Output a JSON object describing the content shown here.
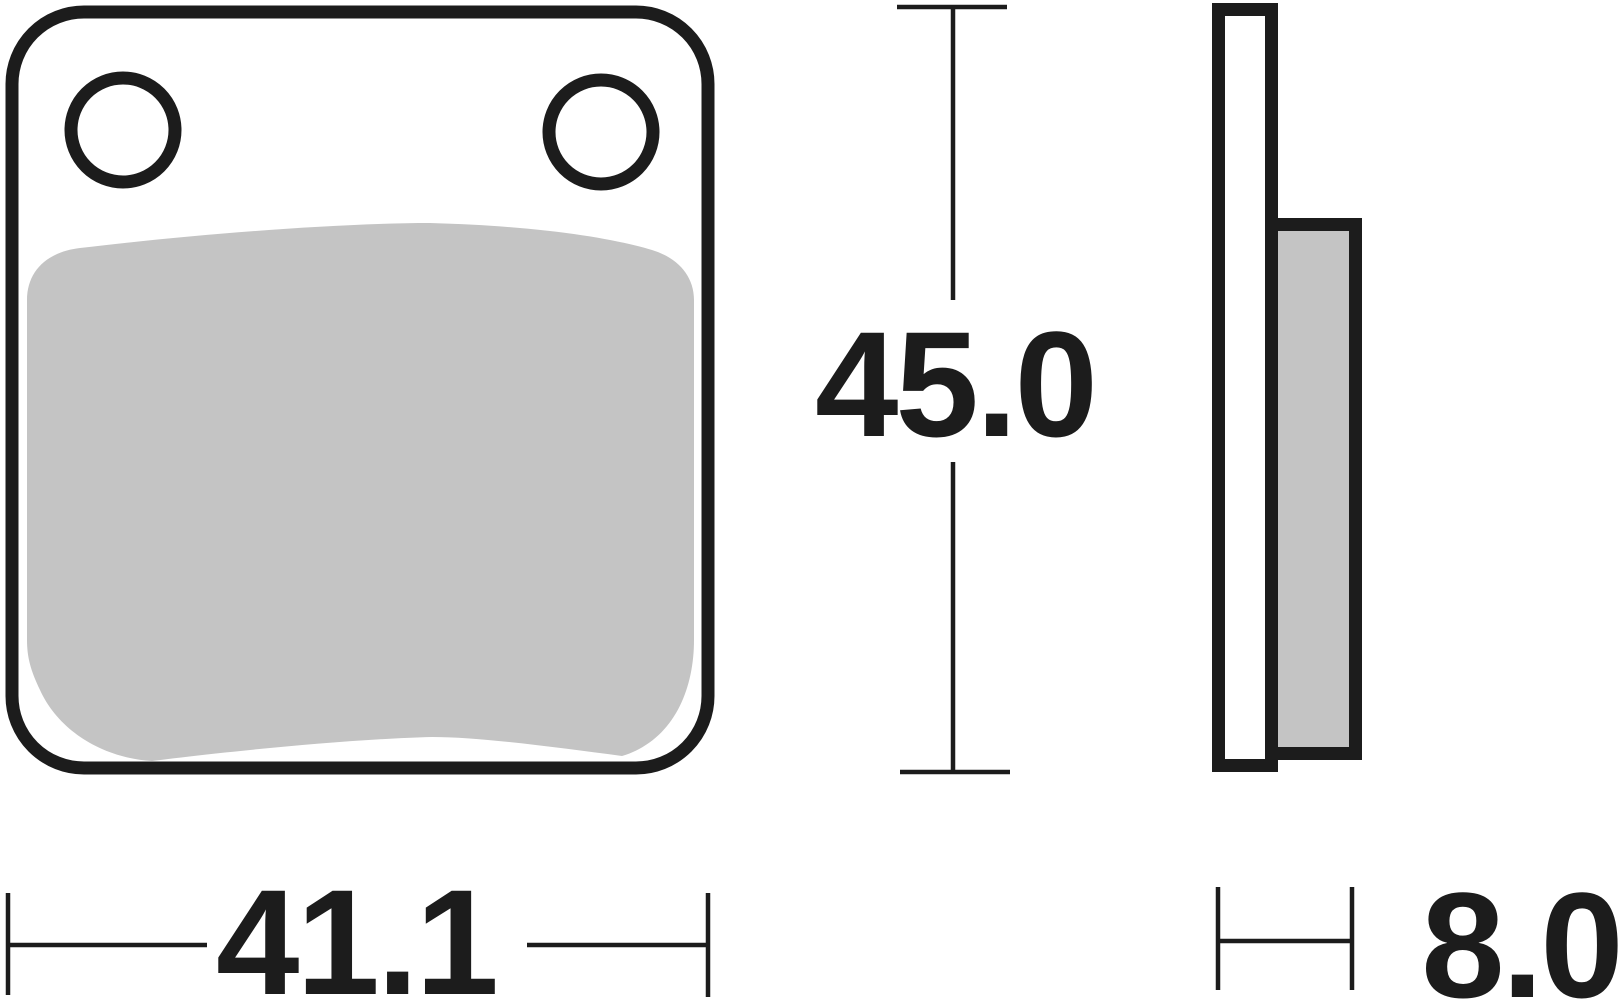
{
  "dimensions": {
    "height": "45.0",
    "width": "41.1",
    "thickness": "8.0"
  },
  "colors": {
    "line_black": "#1c1c1c",
    "friction_gray": "#c4c4c4",
    "plate_white": "#ffffff",
    "background": "#ffffff"
  }
}
